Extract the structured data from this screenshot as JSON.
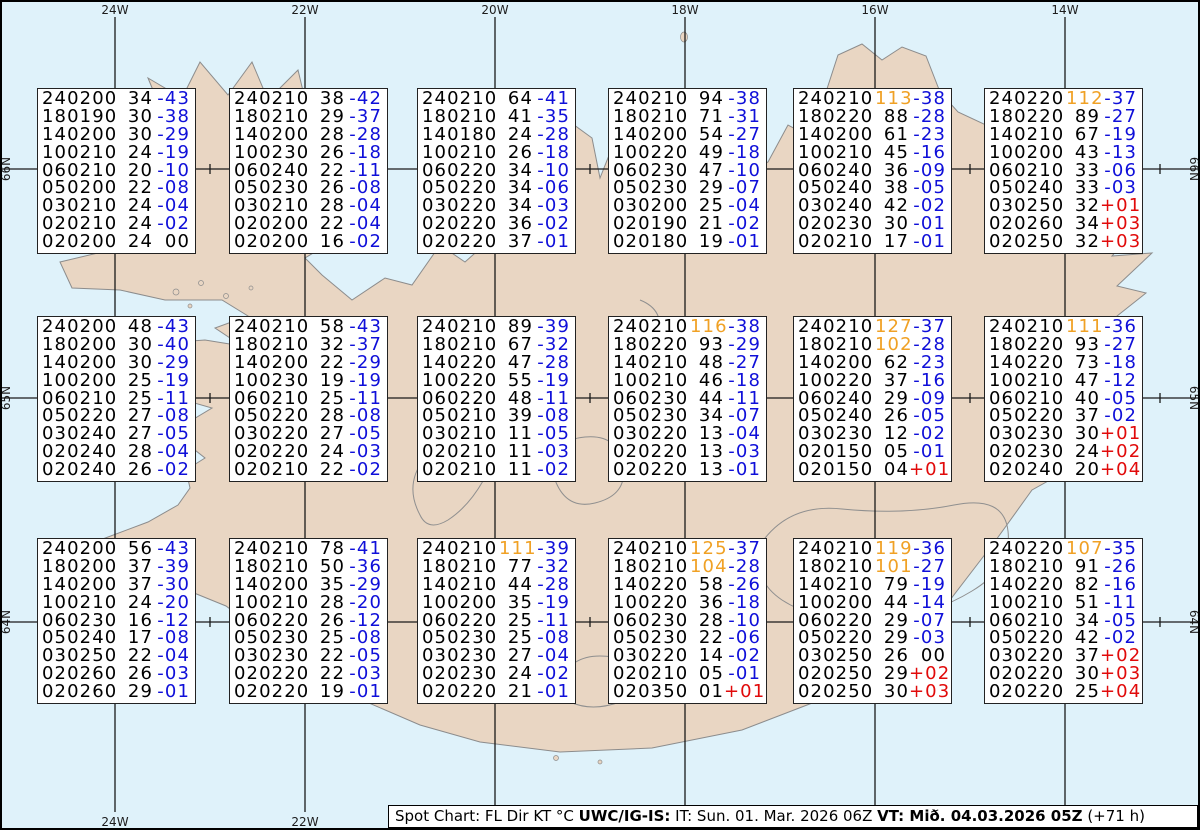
{
  "colors": {
    "water": "#dff2fa",
    "land": "#e9d6c3",
    "coastline": "#8c8c8c",
    "grid": "#1a1a1a",
    "blue": "#0f0fd9",
    "red": "#e10a0a",
    "orange": "#f0a125"
  },
  "axes": {
    "lon_labels": [
      "24W",
      "22W",
      "20W",
      "18W",
      "16W",
      "14W"
    ],
    "lat_labels": [
      "66N",
      "65N",
      "64N"
    ]
  },
  "footer": {
    "prefix": "Spot Chart: FL Dir KT °C ",
    "source_bold": "UWC/IG-IS:",
    "issue_time": " IT: Sun. 01. Mar. 2026 06Z ",
    "valid_bold": "VT: Mið. 04.03.2026 05Z",
    "suffix": " (+71 h)"
  },
  "spot_boxes": [
    {
      "row": 0,
      "col": 0,
      "lines": [
        [
          "240200",
          "34",
          "-43"
        ],
        [
          "180190",
          "30",
          "-38"
        ],
        [
          "140200",
          "30",
          "-29"
        ],
        [
          "100210",
          "24",
          "-19"
        ],
        [
          "060210",
          "20",
          "-10"
        ],
        [
          "050200",
          "22",
          "-08"
        ],
        [
          "030210",
          "24",
          "-04"
        ],
        [
          "020210",
          "24",
          "-02"
        ],
        [
          "020200",
          "24",
          "00"
        ]
      ]
    },
    {
      "row": 0,
      "col": 1,
      "lines": [
        [
          "240210",
          "38",
          "-42"
        ],
        [
          "180210",
          "29",
          "-37"
        ],
        [
          "140200",
          "28",
          "-28"
        ],
        [
          "100230",
          "26",
          "-18"
        ],
        [
          "060240",
          "22",
          "-11"
        ],
        [
          "050230",
          "26",
          "-08"
        ],
        [
          "030210",
          "28",
          "-04"
        ],
        [
          "020200",
          "22",
          "-04"
        ],
        [
          "020200",
          "16",
          "-02"
        ]
      ]
    },
    {
      "row": 0,
      "col": 2,
      "lines": [
        [
          "240210",
          "64",
          "-41"
        ],
        [
          "180210",
          "41",
          "-35"
        ],
        [
          "140180",
          "24",
          "-28"
        ],
        [
          "100210",
          "26",
          "-18"
        ],
        [
          "060220",
          "34",
          "-10"
        ],
        [
          "050220",
          "34",
          "-06"
        ],
        [
          "030220",
          "34",
          "-03"
        ],
        [
          "020220",
          "36",
          "-02"
        ],
        [
          "020220",
          "37",
          "-01"
        ]
      ]
    },
    {
      "row": 0,
      "col": 3,
      "lines": [
        [
          "240210",
          "94",
          "-38"
        ],
        [
          "180210",
          "71",
          "-31"
        ],
        [
          "140200",
          "54",
          "-27"
        ],
        [
          "100220",
          "49",
          "-18"
        ],
        [
          "060230",
          "47",
          "-10"
        ],
        [
          "050230",
          "29",
          "-07"
        ],
        [
          "030200",
          "25",
          "-04"
        ],
        [
          "020190",
          "21",
          "-02"
        ],
        [
          "020180",
          "19",
          "-01"
        ]
      ]
    },
    {
      "row": 0,
      "col": 4,
      "lines": [
        [
          "240210",
          "113",
          "-38"
        ],
        [
          "180220",
          "88",
          "-28"
        ],
        [
          "140200",
          "61",
          "-23"
        ],
        [
          "100210",
          "45",
          "-16"
        ],
        [
          "060240",
          "36",
          "-09"
        ],
        [
          "050240",
          "38",
          "-05"
        ],
        [
          "030240",
          "42",
          "-02"
        ],
        [
          "020230",
          "30",
          "-01"
        ],
        [
          "020210",
          "17",
          "-01"
        ]
      ]
    },
    {
      "row": 0,
      "col": 5,
      "lines": [
        [
          "240220",
          "112",
          "-37"
        ],
        [
          "180220",
          "89",
          "-27"
        ],
        [
          "140210",
          "67",
          "-19"
        ],
        [
          "100200",
          "43",
          "-13"
        ],
        [
          "060210",
          "33",
          "-06"
        ],
        [
          "050240",
          "33",
          "-03"
        ],
        [
          "030250",
          "32",
          "+01"
        ],
        [
          "020260",
          "34",
          "+03"
        ],
        [
          "020250",
          "32",
          "+03"
        ]
      ]
    },
    {
      "row": 1,
      "col": 0,
      "lines": [
        [
          "240200",
          "48",
          "-43"
        ],
        [
          "180200",
          "30",
          "-40"
        ],
        [
          "140200",
          "30",
          "-29"
        ],
        [
          "100200",
          "25",
          "-19"
        ],
        [
          "060210",
          "25",
          "-11"
        ],
        [
          "050220",
          "27",
          "-08"
        ],
        [
          "030240",
          "27",
          "-05"
        ],
        [
          "020240",
          "28",
          "-04"
        ],
        [
          "020240",
          "26",
          "-02"
        ]
      ]
    },
    {
      "row": 1,
      "col": 1,
      "lines": [
        [
          "240210",
          "58",
          "-43"
        ],
        [
          "180210",
          "32",
          "-37"
        ],
        [
          "140200",
          "22",
          "-29"
        ],
        [
          "100230",
          "19",
          "-19"
        ],
        [
          "060210",
          "25",
          "-11"
        ],
        [
          "050220",
          "28",
          "-08"
        ],
        [
          "030220",
          "27",
          "-05"
        ],
        [
          "020220",
          "24",
          "-03"
        ],
        [
          "020210",
          "22",
          "-02"
        ]
      ]
    },
    {
      "row": 1,
      "col": 2,
      "lines": [
        [
          "240210",
          "89",
          "-39"
        ],
        [
          "180210",
          "67",
          "-32"
        ],
        [
          "140220",
          "47",
          "-28"
        ],
        [
          "100220",
          "55",
          "-19"
        ],
        [
          "060220",
          "48",
          "-11"
        ],
        [
          "050210",
          "39",
          "-08"
        ],
        [
          "030210",
          "11",
          "-05"
        ],
        [
          "020210",
          "11",
          "-03"
        ],
        [
          "020210",
          "11",
          "-02"
        ]
      ]
    },
    {
      "row": 1,
      "col": 3,
      "lines": [
        [
          "240210",
          "116",
          "-38"
        ],
        [
          "180220",
          "93",
          "-29"
        ],
        [
          "140210",
          "48",
          "-27"
        ],
        [
          "100210",
          "46",
          "-18"
        ],
        [
          "060230",
          "44",
          "-11"
        ],
        [
          "050230",
          "34",
          "-07"
        ],
        [
          "030220",
          "13",
          "-04"
        ],
        [
          "020220",
          "13",
          "-03"
        ],
        [
          "020220",
          "13",
          "-01"
        ]
      ]
    },
    {
      "row": 1,
      "col": 4,
      "lines": [
        [
          "240210",
          "127",
          "-37"
        ],
        [
          "180210",
          "102",
          "-28"
        ],
        [
          "140200",
          "62",
          "-23"
        ],
        [
          "100220",
          "37",
          "-16"
        ],
        [
          "060240",
          "29",
          "-09"
        ],
        [
          "050240",
          "26",
          "-05"
        ],
        [
          "030230",
          "12",
          "-02"
        ],
        [
          "020150",
          "05",
          "-01"
        ],
        [
          "020150",
          "04",
          "+01"
        ]
      ]
    },
    {
      "row": 1,
      "col": 5,
      "lines": [
        [
          "240210",
          "111",
          "-36"
        ],
        [
          "180220",
          "93",
          "-27"
        ],
        [
          "140220",
          "73",
          "-18"
        ],
        [
          "100210",
          "47",
          "-12"
        ],
        [
          "060210",
          "40",
          "-05"
        ],
        [
          "050220",
          "37",
          "-02"
        ],
        [
          "030230",
          "30",
          "+01"
        ],
        [
          "020230",
          "24",
          "+02"
        ],
        [
          "020240",
          "20",
          "+04"
        ]
      ]
    },
    {
      "row": 2,
      "col": 0,
      "lines": [
        [
          "240200",
          "56",
          "-43"
        ],
        [
          "180200",
          "37",
          "-39"
        ],
        [
          "140200",
          "37",
          "-30"
        ],
        [
          "100210",
          "24",
          "-20"
        ],
        [
          "060230",
          "16",
          "-12"
        ],
        [
          "050240",
          "17",
          "-08"
        ],
        [
          "030250",
          "22",
          "-04"
        ],
        [
          "020260",
          "26",
          "-03"
        ],
        [
          "020260",
          "29",
          "-01"
        ]
      ]
    },
    {
      "row": 2,
      "col": 1,
      "lines": [
        [
          "240210",
          "78",
          "-41"
        ],
        [
          "180210",
          "50",
          "-36"
        ],
        [
          "140200",
          "35",
          "-29"
        ],
        [
          "100210",
          "28",
          "-20"
        ],
        [
          "060220",
          "26",
          "-12"
        ],
        [
          "050230",
          "25",
          "-08"
        ],
        [
          "030230",
          "22",
          "-05"
        ],
        [
          "020220",
          "22",
          "-03"
        ],
        [
          "020220",
          "19",
          "-01"
        ]
      ]
    },
    {
      "row": 2,
      "col": 2,
      "lines": [
        [
          "240210",
          "111",
          "-39"
        ],
        [
          "180210",
          "77",
          "-32"
        ],
        [
          "140210",
          "44",
          "-28"
        ],
        [
          "100200",
          "35",
          "-19"
        ],
        [
          "060220",
          "25",
          "-11"
        ],
        [
          "050230",
          "25",
          "-08"
        ],
        [
          "030230",
          "27",
          "-04"
        ],
        [
          "020230",
          "24",
          "-02"
        ],
        [
          "020220",
          "21",
          "-01"
        ]
      ]
    },
    {
      "row": 2,
      "col": 3,
      "lines": [
        [
          "240210",
          "125",
          "-37"
        ],
        [
          "180210",
          "104",
          "-28"
        ],
        [
          "140220",
          "58",
          "-26"
        ],
        [
          "100220",
          "36",
          "-18"
        ],
        [
          "060230",
          "28",
          "-10"
        ],
        [
          "050230",
          "22",
          "-06"
        ],
        [
          "030220",
          "14",
          "-02"
        ],
        [
          "020210",
          "05",
          "-01"
        ],
        [
          "020350",
          "01",
          "+01"
        ]
      ]
    },
    {
      "row": 2,
      "col": 4,
      "lines": [
        [
          "240210",
          "119",
          "-36"
        ],
        [
          "180210",
          "101",
          "-27"
        ],
        [
          "140210",
          "79",
          "-19"
        ],
        [
          "100200",
          "44",
          "-14"
        ],
        [
          "060220",
          "29",
          "-07"
        ],
        [
          "050220",
          "29",
          "-03"
        ],
        [
          "030250",
          "26",
          "00"
        ],
        [
          "020250",
          "29",
          "+02"
        ],
        [
          "020250",
          "30",
          "+03"
        ]
      ]
    },
    {
      "row": 2,
      "col": 5,
      "lines": [
        [
          "240220",
          "107",
          "-35"
        ],
        [
          "180210",
          "91",
          "-26"
        ],
        [
          "140220",
          "82",
          "-16"
        ],
        [
          "100210",
          "51",
          "-11"
        ],
        [
          "060210",
          "34",
          "-05"
        ],
        [
          "050220",
          "42",
          "-02"
        ],
        [
          "030220",
          "37",
          "+02"
        ],
        [
          "020220",
          "30",
          "+03"
        ],
        [
          "020220",
          "25",
          "+04"
        ]
      ]
    }
  ]
}
